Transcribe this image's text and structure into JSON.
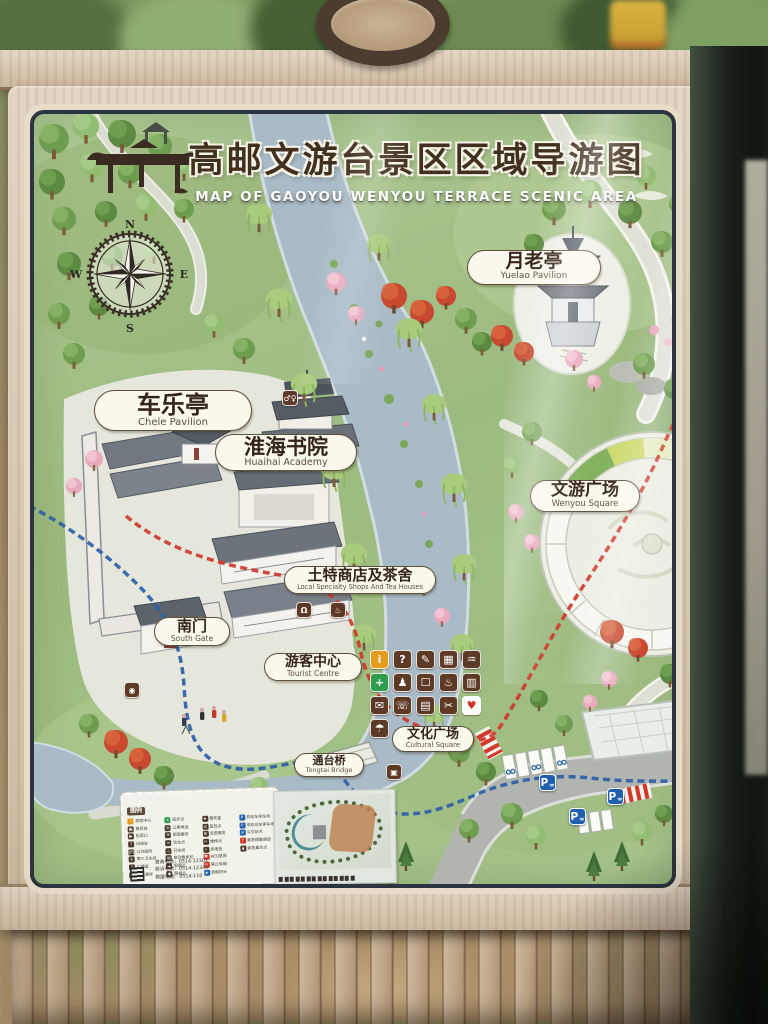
{
  "sign": {
    "title_cn": "高邮文游台景区区域导游图",
    "title_en": "MAP OF GAOYOU WENYOU TERRACE SCENIC AREA",
    "compass": {
      "n": "N",
      "e": "E",
      "s": "S",
      "w": "W"
    },
    "place_labels": [
      {
        "cn": "月老亭",
        "en": "Yuelao Pavilion"
      },
      {
        "cn": "车乐亭",
        "en": "Chele Pavilion"
      },
      {
        "cn": "淮海书院",
        "en": "Huaihai Academy"
      },
      {
        "cn": "文游广场",
        "en": "Wenyou Square"
      },
      {
        "cn": "土特商店及茶舍",
        "en": "Local Specialty Shops And Tea Houses"
      },
      {
        "cn": "南门",
        "en": "South Gate"
      },
      {
        "cn": "游客中心",
        "en": "Tourist Centre"
      },
      {
        "cn": "文化广场",
        "en": "Cultural Square"
      },
      {
        "cn": "通台桥",
        "en": "Tongtai Bridge"
      }
    ],
    "service_grid": [
      {
        "name": "information",
        "glyph": "i",
        "bg": "#e59b1e",
        "fg": "#ffffff"
      },
      {
        "name": "inquiry",
        "glyph": "?",
        "bg": "#5d3a26",
        "fg": "#ffffff"
      },
      {
        "name": "guide-service",
        "glyph": "✎",
        "bg": "#5d3a26",
        "fg": "#ffffff"
      },
      {
        "name": "lockers",
        "glyph": "▦",
        "bg": "#5d3a26",
        "fg": "#ffffff"
      },
      {
        "name": "drinking-water",
        "glyph": "♒",
        "bg": "#5d3a26",
        "fg": "#ffffff"
      },
      {
        "name": "first-aid",
        "glyph": "+",
        "bg": "#2f9e4f",
        "fg": "#ffffff"
      },
      {
        "name": "baby-care",
        "glyph": "♟",
        "bg": "#5d3a26",
        "fg": "#ffffff"
      },
      {
        "name": "info-kiosk",
        "glyph": "☐",
        "bg": "#5d3a26",
        "fg": "#ffffff"
      },
      {
        "name": "hot-water",
        "glyph": "♨",
        "bg": "#5d3a26",
        "fg": "#ffffff"
      },
      {
        "name": "luggage",
        "glyph": "▥",
        "bg": "#5d3a26",
        "fg": "#ffffff"
      },
      {
        "name": "postal",
        "glyph": "✉",
        "bg": "#5d3a26",
        "fg": "#ffffff"
      },
      {
        "name": "telephone",
        "glyph": "☏",
        "bg": "#5d3a26",
        "fg": "#ffffff"
      },
      {
        "name": "reading-corner",
        "glyph": "▤",
        "bg": "#5d3a26",
        "fg": "#ffffff"
      },
      {
        "name": "repair",
        "glyph": "✂",
        "bg": "#5d3a26",
        "fg": "#ffffff"
      },
      {
        "name": "aed",
        "glyph": "♥",
        "bg": "#ffffff",
        "fg": "#d2392b"
      },
      {
        "name": "umbrella",
        "glyph": "☂",
        "bg": "#5d3a26",
        "fg": "#ffffff"
      }
    ],
    "spot_icons": [
      {
        "name": "restroom",
        "glyph": "♂♀"
      },
      {
        "name": "shopping",
        "glyph": "Ω"
      },
      {
        "name": "teahouse",
        "glyph": "♨"
      },
      {
        "name": "photo-spot",
        "glyph": "◉"
      },
      {
        "name": "service-point",
        "glyph": "▣"
      }
    ],
    "parking": {
      "label": "P",
      "bike_glyph": "∞"
    },
    "legend": {
      "title": "图例",
      "col1": [
        {
          "g": "i",
          "c": "#e59b1e",
          "t": "游客中心"
        },
        {
          "g": "▣",
          "c": "#4a3a2c",
          "t": "售票处"
        },
        {
          "g": "▶",
          "c": "#4a3a2c",
          "t": "检票口"
        },
        {
          "g": "?",
          "c": "#4a3a2c",
          "t": "问询处"
        },
        {
          "g": "♂♀",
          "c": "#4a3a2c",
          "t": "公共厕所"
        },
        {
          "g": "♿",
          "c": "#4a3a2c",
          "t": "第三卫生间"
        },
        {
          "g": "♪",
          "c": "#4a3a2c",
          "t": "广播室"
        },
        {
          "g": "▦",
          "c": "#4a3a2c",
          "t": "行李寄存"
        }
      ],
      "col2": [
        {
          "g": "+",
          "c": "#2f9e4f",
          "t": "医疗点"
        },
        {
          "g": "☏",
          "c": "#4a3a2c",
          "t": "公用电话"
        },
        {
          "g": "✉",
          "c": "#4a3a2c",
          "t": "邮政服务"
        },
        {
          "g": "♒",
          "c": "#4a3a2c",
          "t": "饮水点"
        },
        {
          "g": "♨",
          "c": "#4a3a2c",
          "t": "开水间"
        },
        {
          "g": "▤",
          "c": "#4a3a2c",
          "t": "自动售卖机"
        },
        {
          "g": "☁",
          "c": "#4a3a2c",
          "t": "吸烟点"
        },
        {
          "g": "◉",
          "c": "#4a3a2c",
          "t": "照相点"
        }
      ],
      "col3": [
        {
          "g": "★",
          "c": "#4a3a2c",
          "t": "警务室"
        },
        {
          "g": "◎",
          "c": "#4a3a2c",
          "t": "监控点"
        },
        {
          "g": "✿",
          "c": "#4a3a2c",
          "t": "志愿服务"
        },
        {
          "g": "✂",
          "c": "#4a3a2c",
          "t": "维修点"
        },
        {
          "g": "⚡",
          "c": "#4a3a2c",
          "t": "充电桩"
        },
        {
          "g": "♥",
          "c": "#d2392b",
          "t": "AED急救"
        },
        {
          "g": "⊘",
          "c": "#d2392b",
          "t": "禁止吸烟"
        },
        {
          "g": "◈",
          "c": "#2563a8",
          "t": "游船码头"
        }
      ],
      "col4": [
        {
          "g": "P",
          "c": "#2563a8",
          "t": "机动车停车场"
        },
        {
          "g": "P",
          "c": "#2563a8",
          "t": "非机动车停车场"
        },
        {
          "g": "≡",
          "c": "#2563a8",
          "t": "公交站点"
        },
        {
          "g": "↑",
          "c": "#d2392b",
          "t": "紧急疏散通道"
        },
        {
          "g": "♟",
          "c": "#4a3a2c",
          "t": "紧急集合点"
        }
      ],
      "phones": [
        "咨询电话：0514-12301",
        "投诉电话：0514-12345",
        "救援电话：0514-110"
      ]
    }
  },
  "colors": {
    "route_red": "#cf3a2a",
    "route_blue": "#2f5fa8",
    "river": "#a9bbc7",
    "parking_blue": "#1f5fae",
    "poster_green": "#a6c48b"
  }
}
